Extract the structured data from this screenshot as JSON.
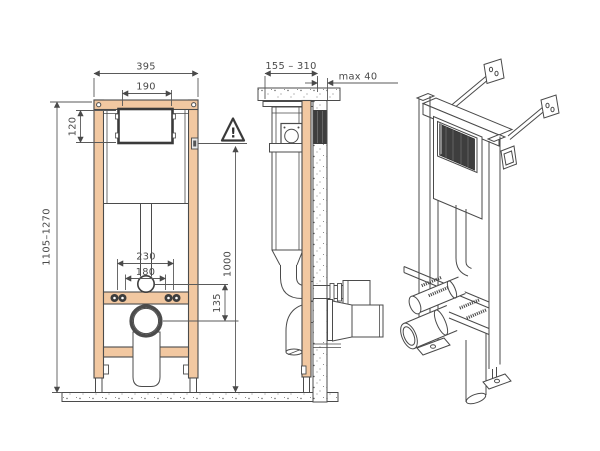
{
  "front_view": {
    "overall_width": "395",
    "opening_width": "190",
    "opening_height": "120",
    "frame_height_range": "1105–1270",
    "fixing_spacing_outer": "230",
    "fixing_spacing_inner": "180",
    "outlet_offset": "135",
    "reference_height": "1000",
    "warning_mark": "!"
  },
  "side_view": {
    "mounting_depth_range": "155 – 310",
    "max_finish_depth": "max 40"
  },
  "colors": {
    "profile_fill": "#f2c8a1",
    "line": "#4b4b4b",
    "panel_dark": "#3e3e3e",
    "dimension_text": "#4a4a4a"
  }
}
